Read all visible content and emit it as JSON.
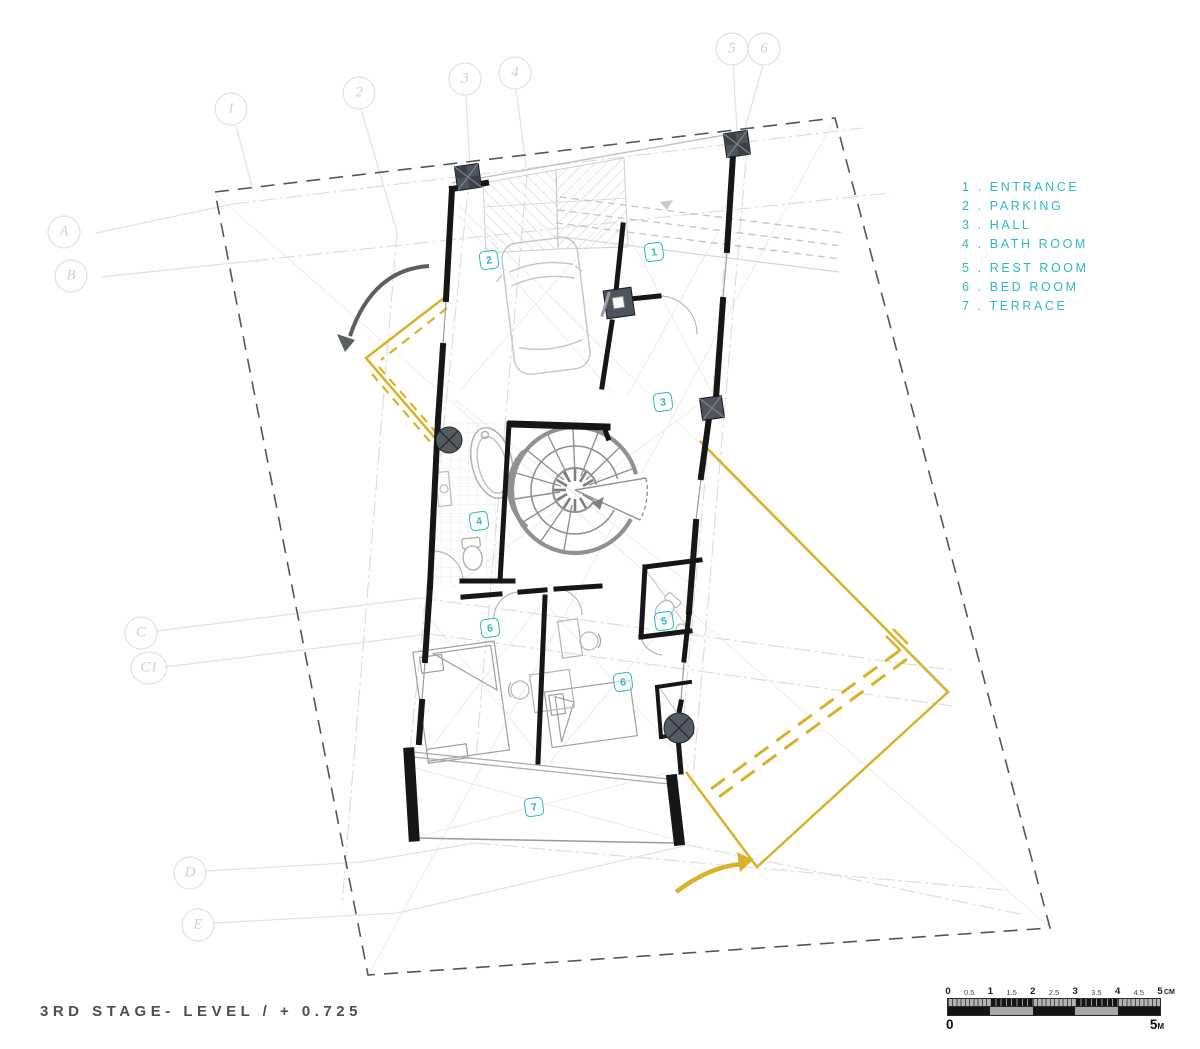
{
  "title": "3RD STAGE- LEVEL / + 0.725",
  "colors": {
    "teal": "#2FB9C1",
    "yellow": "#D9B22C",
    "wall": "#161616",
    "boundary": "#555555",
    "grid_light": "#DCDCDC"
  },
  "legend": {
    "items": [
      {
        "num": "1",
        "label": "ENTRANCE"
      },
      {
        "num": "2",
        "label": "PARKING"
      },
      {
        "num": "3",
        "label": "HALL"
      },
      {
        "num": "4",
        "label": "BATH ROOM"
      },
      {
        "num": "5",
        "label": "REST ROOM"
      },
      {
        "num": "6",
        "label": "BED ROOM"
      },
      {
        "num": "7",
        "label": "TERRACE"
      }
    ]
  },
  "grid_markers": {
    "columns": [
      {
        "label": "1",
        "x": 231,
        "y": 109
      },
      {
        "label": "2",
        "x": 359,
        "y": 93
      },
      {
        "label": "3",
        "x": 465,
        "y": 79
      },
      {
        "label": "4",
        "x": 515,
        "y": 73
      },
      {
        "label": "5",
        "x": 732,
        "y": 49
      },
      {
        "label": "6",
        "x": 764,
        "y": 49
      }
    ],
    "rows": [
      {
        "label": "A",
        "x": 64,
        "y": 232
      },
      {
        "label": "B",
        "x": 71,
        "y": 276
      },
      {
        "label": "C",
        "x": 141,
        "y": 633
      },
      {
        "label": "C1",
        "x": 149,
        "y": 668,
        "wide": true
      },
      {
        "label": "D",
        "x": 190,
        "y": 873
      },
      {
        "label": "E",
        "x": 198,
        "y": 925
      }
    ]
  },
  "room_tags": [
    {
      "label": "2",
      "x": 489,
      "y": 260
    },
    {
      "label": "1",
      "x": 654,
      "y": 252
    },
    {
      "label": "3",
      "x": 663,
      "y": 402
    },
    {
      "label": "4",
      "x": 479,
      "y": 521
    },
    {
      "label": "6",
      "x": 490,
      "y": 628
    },
    {
      "label": "5",
      "x": 664,
      "y": 621
    },
    {
      "label": "6",
      "x": 623,
      "y": 682
    },
    {
      "label": "7",
      "x": 534,
      "y": 807
    }
  ],
  "scale_bar": {
    "cm_labels": [
      "0",
      "0.5",
      "1",
      "1.5",
      "2",
      "2.5",
      "3",
      "3.5",
      "4",
      "4.5",
      "5"
    ],
    "cm_unit": "CM",
    "m_left": "0",
    "m_right": "5",
    "m_unit": "M"
  }
}
